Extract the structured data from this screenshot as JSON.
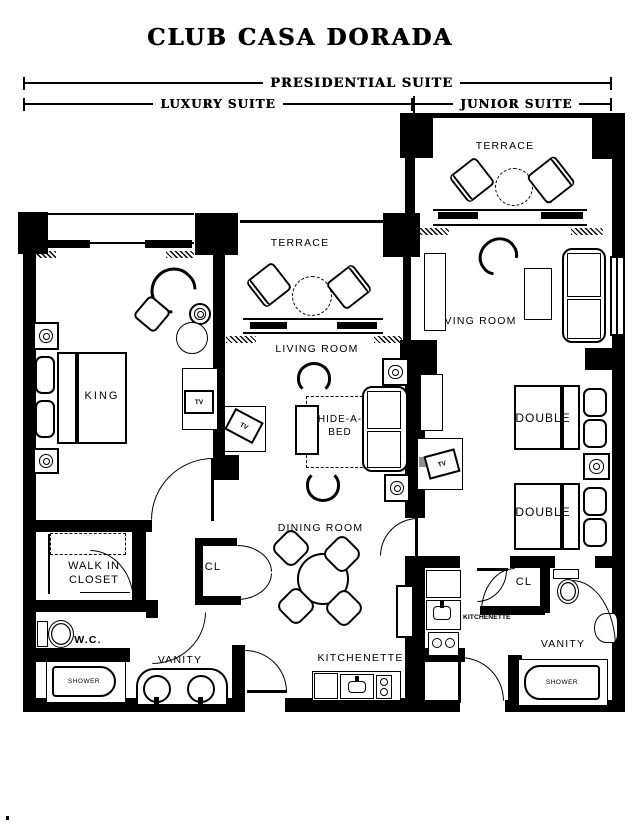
{
  "title": "CLUB CASA DORADA",
  "suite_spans": {
    "presidential": "PRESIDENTIAL SUITE",
    "luxury": "LUXURY SUITE",
    "junior": "JUNIOR SUITE"
  },
  "luxury_suite": {
    "terrace": "TERRACE",
    "living_room": "LIVING ROOM",
    "king_bed": "KING",
    "hide_a_bed": "HIDE-A-BED",
    "dining_room": "DINING ROOM",
    "kitchenette": "KITCHENETTE",
    "walk_in_closet": "WALK IN CLOSET",
    "closet": "CL",
    "wc": "W.C.",
    "vanity": "VANITY",
    "shower": "SHOWER",
    "bedroom_tv": "TV",
    "living_tv": "TV"
  },
  "junior_suite": {
    "terrace": "TERRACE",
    "living_room": "LIVING ROOM",
    "double_bed_1": "DOUBLE",
    "double_bed_2": "DOUBLE",
    "kitchenette": "KITCHENETTE",
    "closet": "CL",
    "vanity": "VANITY",
    "shower": "SHOWER",
    "bedroom_tv": "TV"
  },
  "colors": {
    "ink": "#000000",
    "paper": "#ffffff"
  }
}
